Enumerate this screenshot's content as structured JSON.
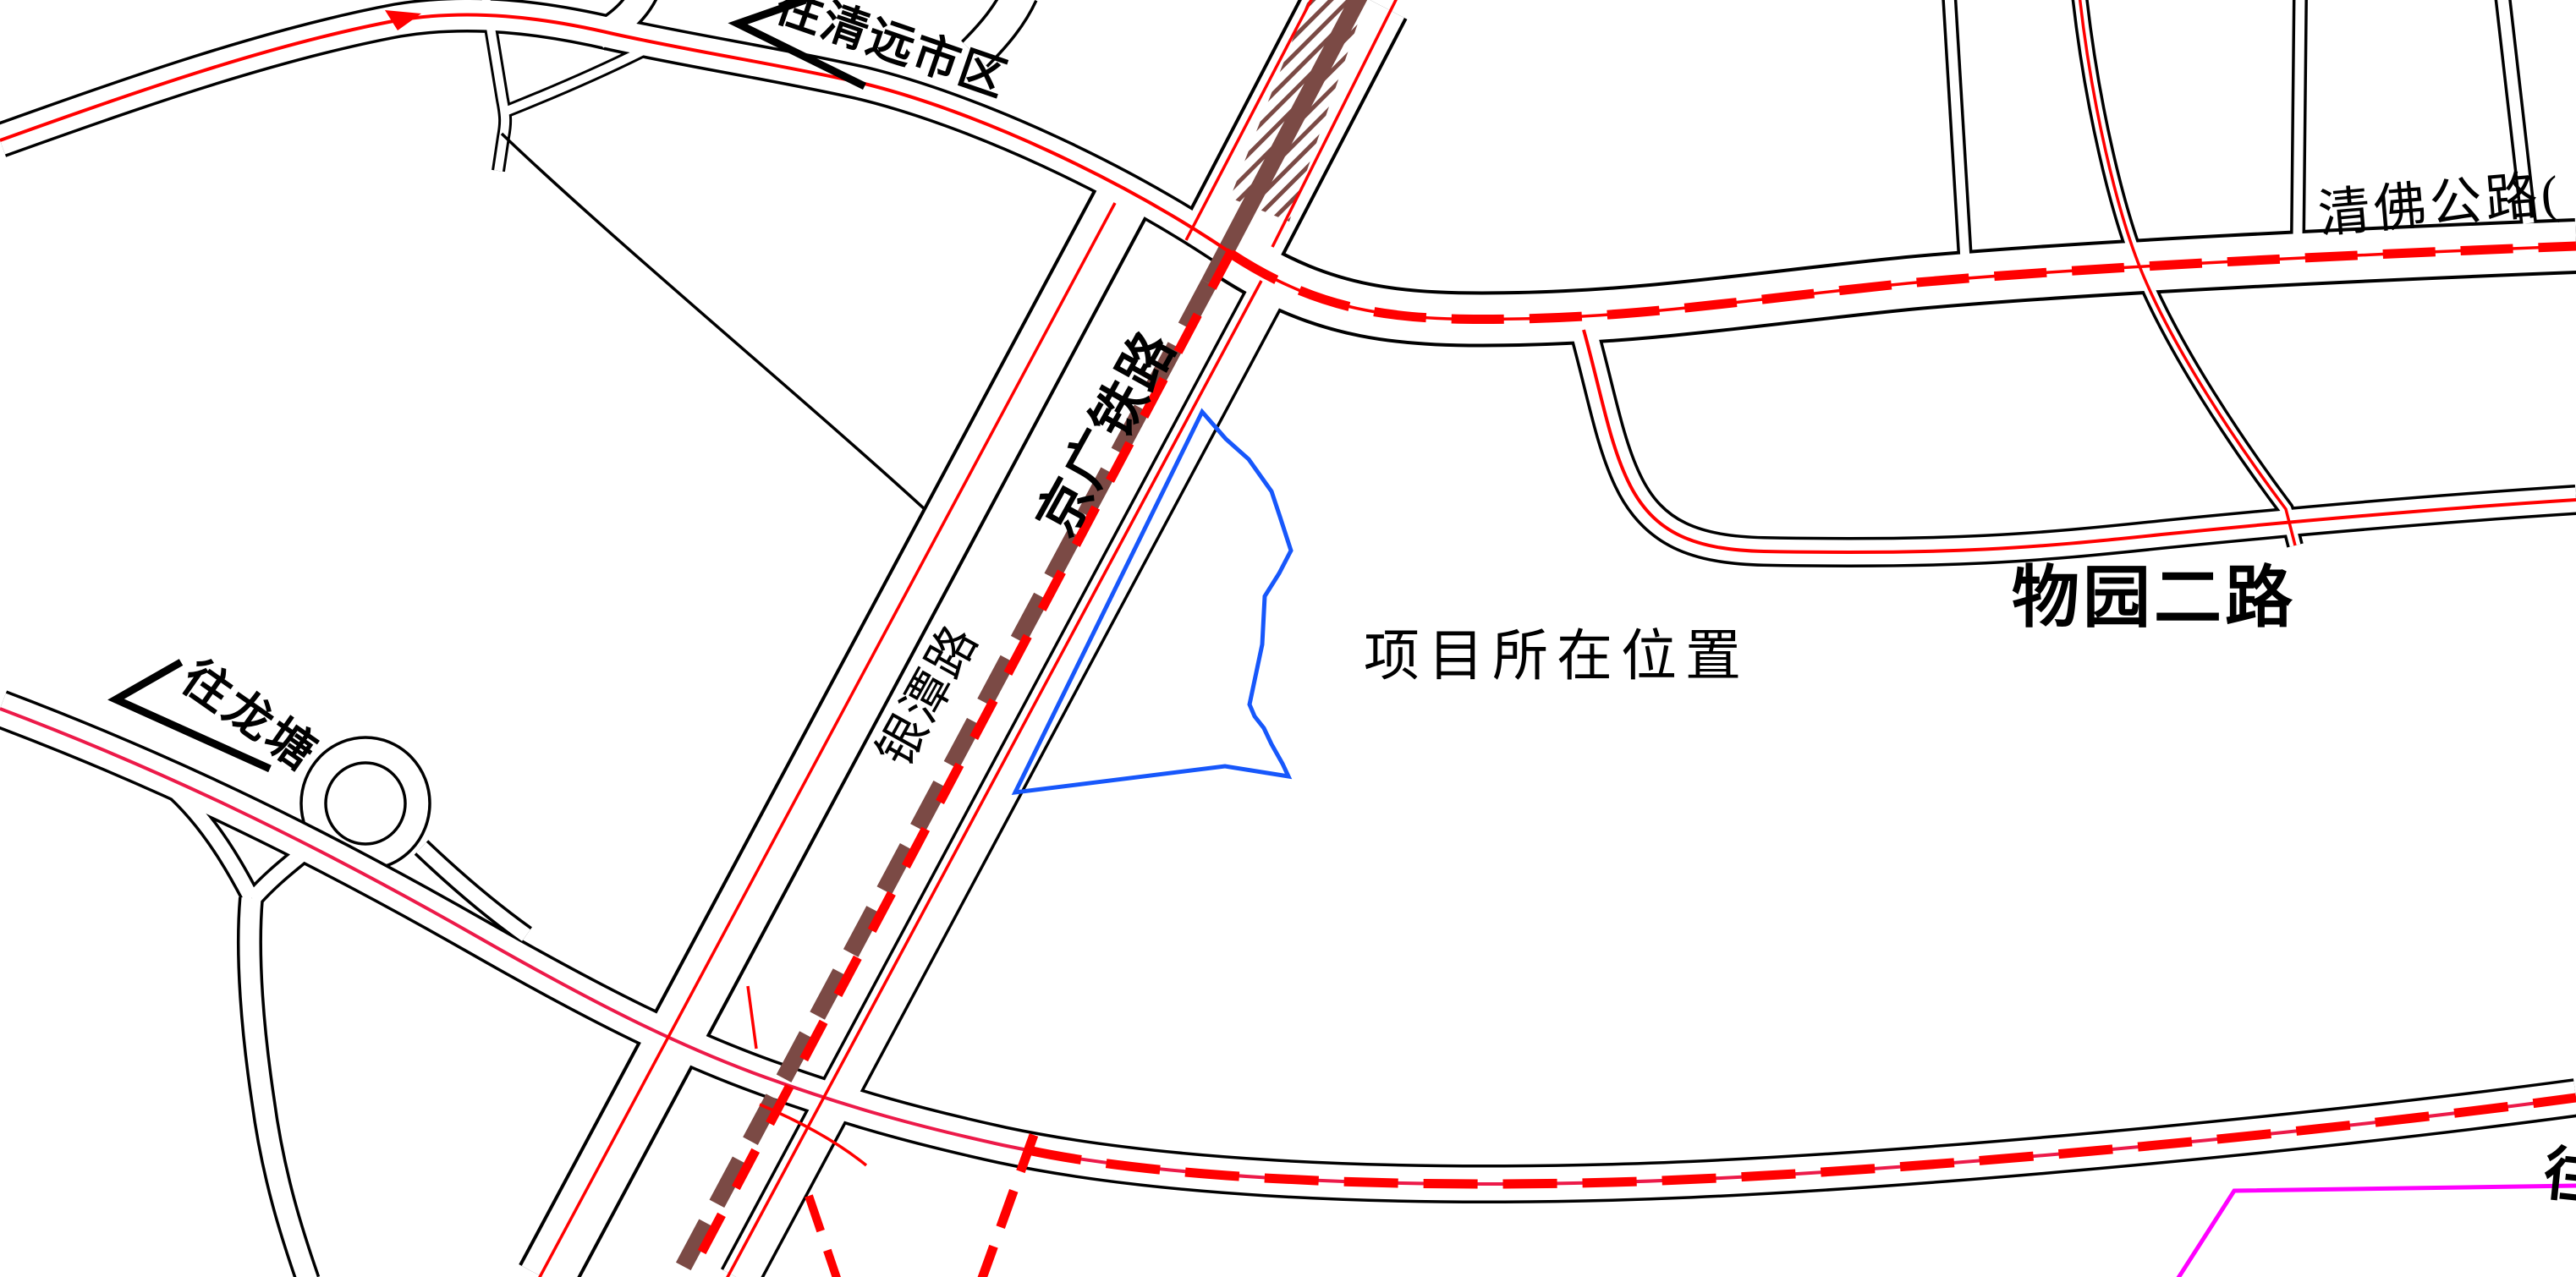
{
  "map": {
    "labels": {
      "to_qingyuan": "往清远市区",
      "qingfo_highway": "清佛公路(",
      "jingguang_railway": "京广铁路",
      "yintan_road": "银潭路",
      "wuyuan_er_road": "物园二路",
      "project_location": "项目所在位置",
      "to_longtang": "往龙塘",
      "edge_partial_label": "往"
    },
    "features": {
      "project_boundary": "blue polygon outline",
      "railway": "brown dashed band with red dashes and hatched bridge area",
      "planned_route": "thick red dashed overlay",
      "roads": "black double-edge lines with red center lines"
    },
    "colors": {
      "line-black": "#000000",
      "road-red": "#FF0000",
      "highway-crimson": "#EC1A49",
      "railway-brown": "#7B4A45",
      "boundary-blue": "#1757FB",
      "boundary-magenta": "#FF00FF"
    }
  }
}
